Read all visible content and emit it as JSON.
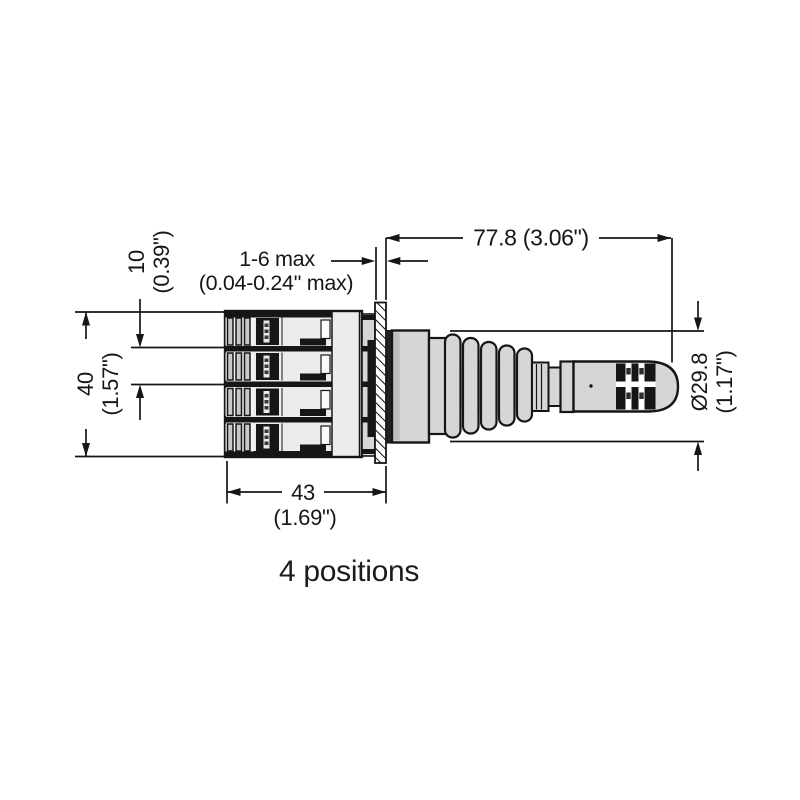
{
  "caption": "4 positions",
  "dimensions": {
    "overall_length": {
      "label": "77.8 (3.06\")"
    },
    "panel_thickness": {
      "line1": "1-6 max",
      "line2": "(0.04-0.24\" max)"
    },
    "contact_pitch": {
      "line1": "10",
      "line2": "(0.39\")"
    },
    "block_height": {
      "line1": "40",
      "line2": "(1.57\")"
    },
    "block_width": {
      "line1": "43",
      "line2": "(1.69\")"
    },
    "head_diameter": {
      "line1": "Ø29.8",
      "line2": "(1.17\")"
    }
  },
  "colors": {
    "line": "#161616",
    "fill_light": "#d6d6d6",
    "fill_body": "#ececec",
    "background": "#ffffff"
  }
}
